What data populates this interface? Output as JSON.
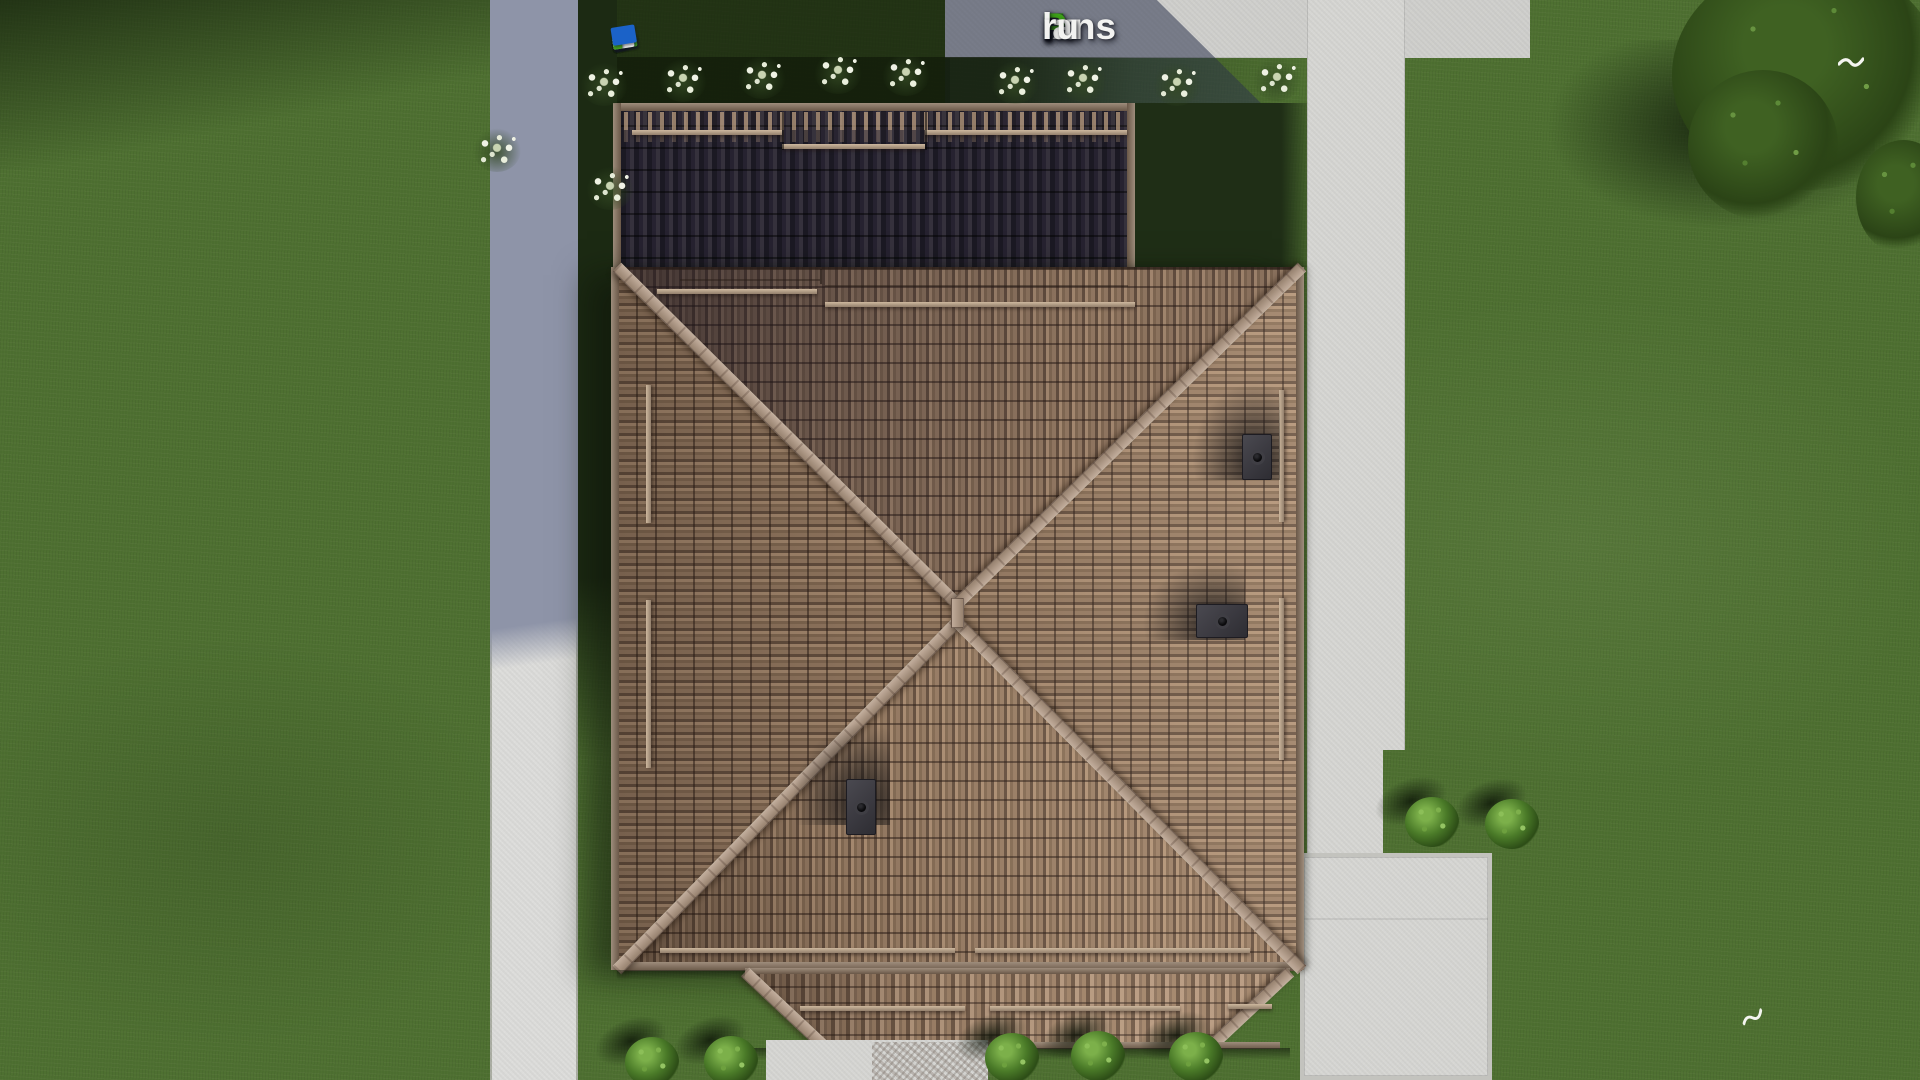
{
  "watermark": {
    "full_text": "FixPlans.ru",
    "segments": [
      {
        "text": "F",
        "color": "#2e6ddf",
        "accent_color": "#3aa11c"
      },
      {
        "text": "ix",
        "color": "#f3f3f1"
      },
      {
        "text": "P",
        "color": "#3da018"
      },
      {
        "text": "lans",
        "color": "#f3f3f1"
      },
      {
        "text": ".",
        "color": "#2d9fd8"
      },
      {
        "text": "ru",
        "color": "#f3f3f1"
      }
    ]
  },
  "scene": {
    "view": "top-down aerial render of a house plot",
    "palette": {
      "grass": "#4e7031",
      "grass_shadow": "#213318",
      "road": "#dcdcda",
      "road_shadow": "#8e94a8",
      "pavement": "#d5d5d2",
      "roof_tile": "#9c8270",
      "roof_tile_dark": "#221f26",
      "roof_ridge": "#ab9889",
      "porch_tile": "#9a8170",
      "chimney": "#3b3a40",
      "tree_foliage": "#2f4a1c",
      "flower_bush": "#e9eede",
      "vehicle_blue": "#1b62c8",
      "vehicle_green": "#3f9e20",
      "bird": "#f4f5f0"
    },
    "objects": {
      "main_roof": "hipped tiled roof with X ridges",
      "rear_roof": "dark shadowed rear roof slope",
      "porch_roof": "lower porch roof",
      "chimney_count": 3,
      "bird_count": 2,
      "left_road": "vertical driveway on left",
      "right_path": "vertical footpath on right",
      "patio": "paved patio bottom-right",
      "walkway": "paved walkway below porch"
    }
  }
}
